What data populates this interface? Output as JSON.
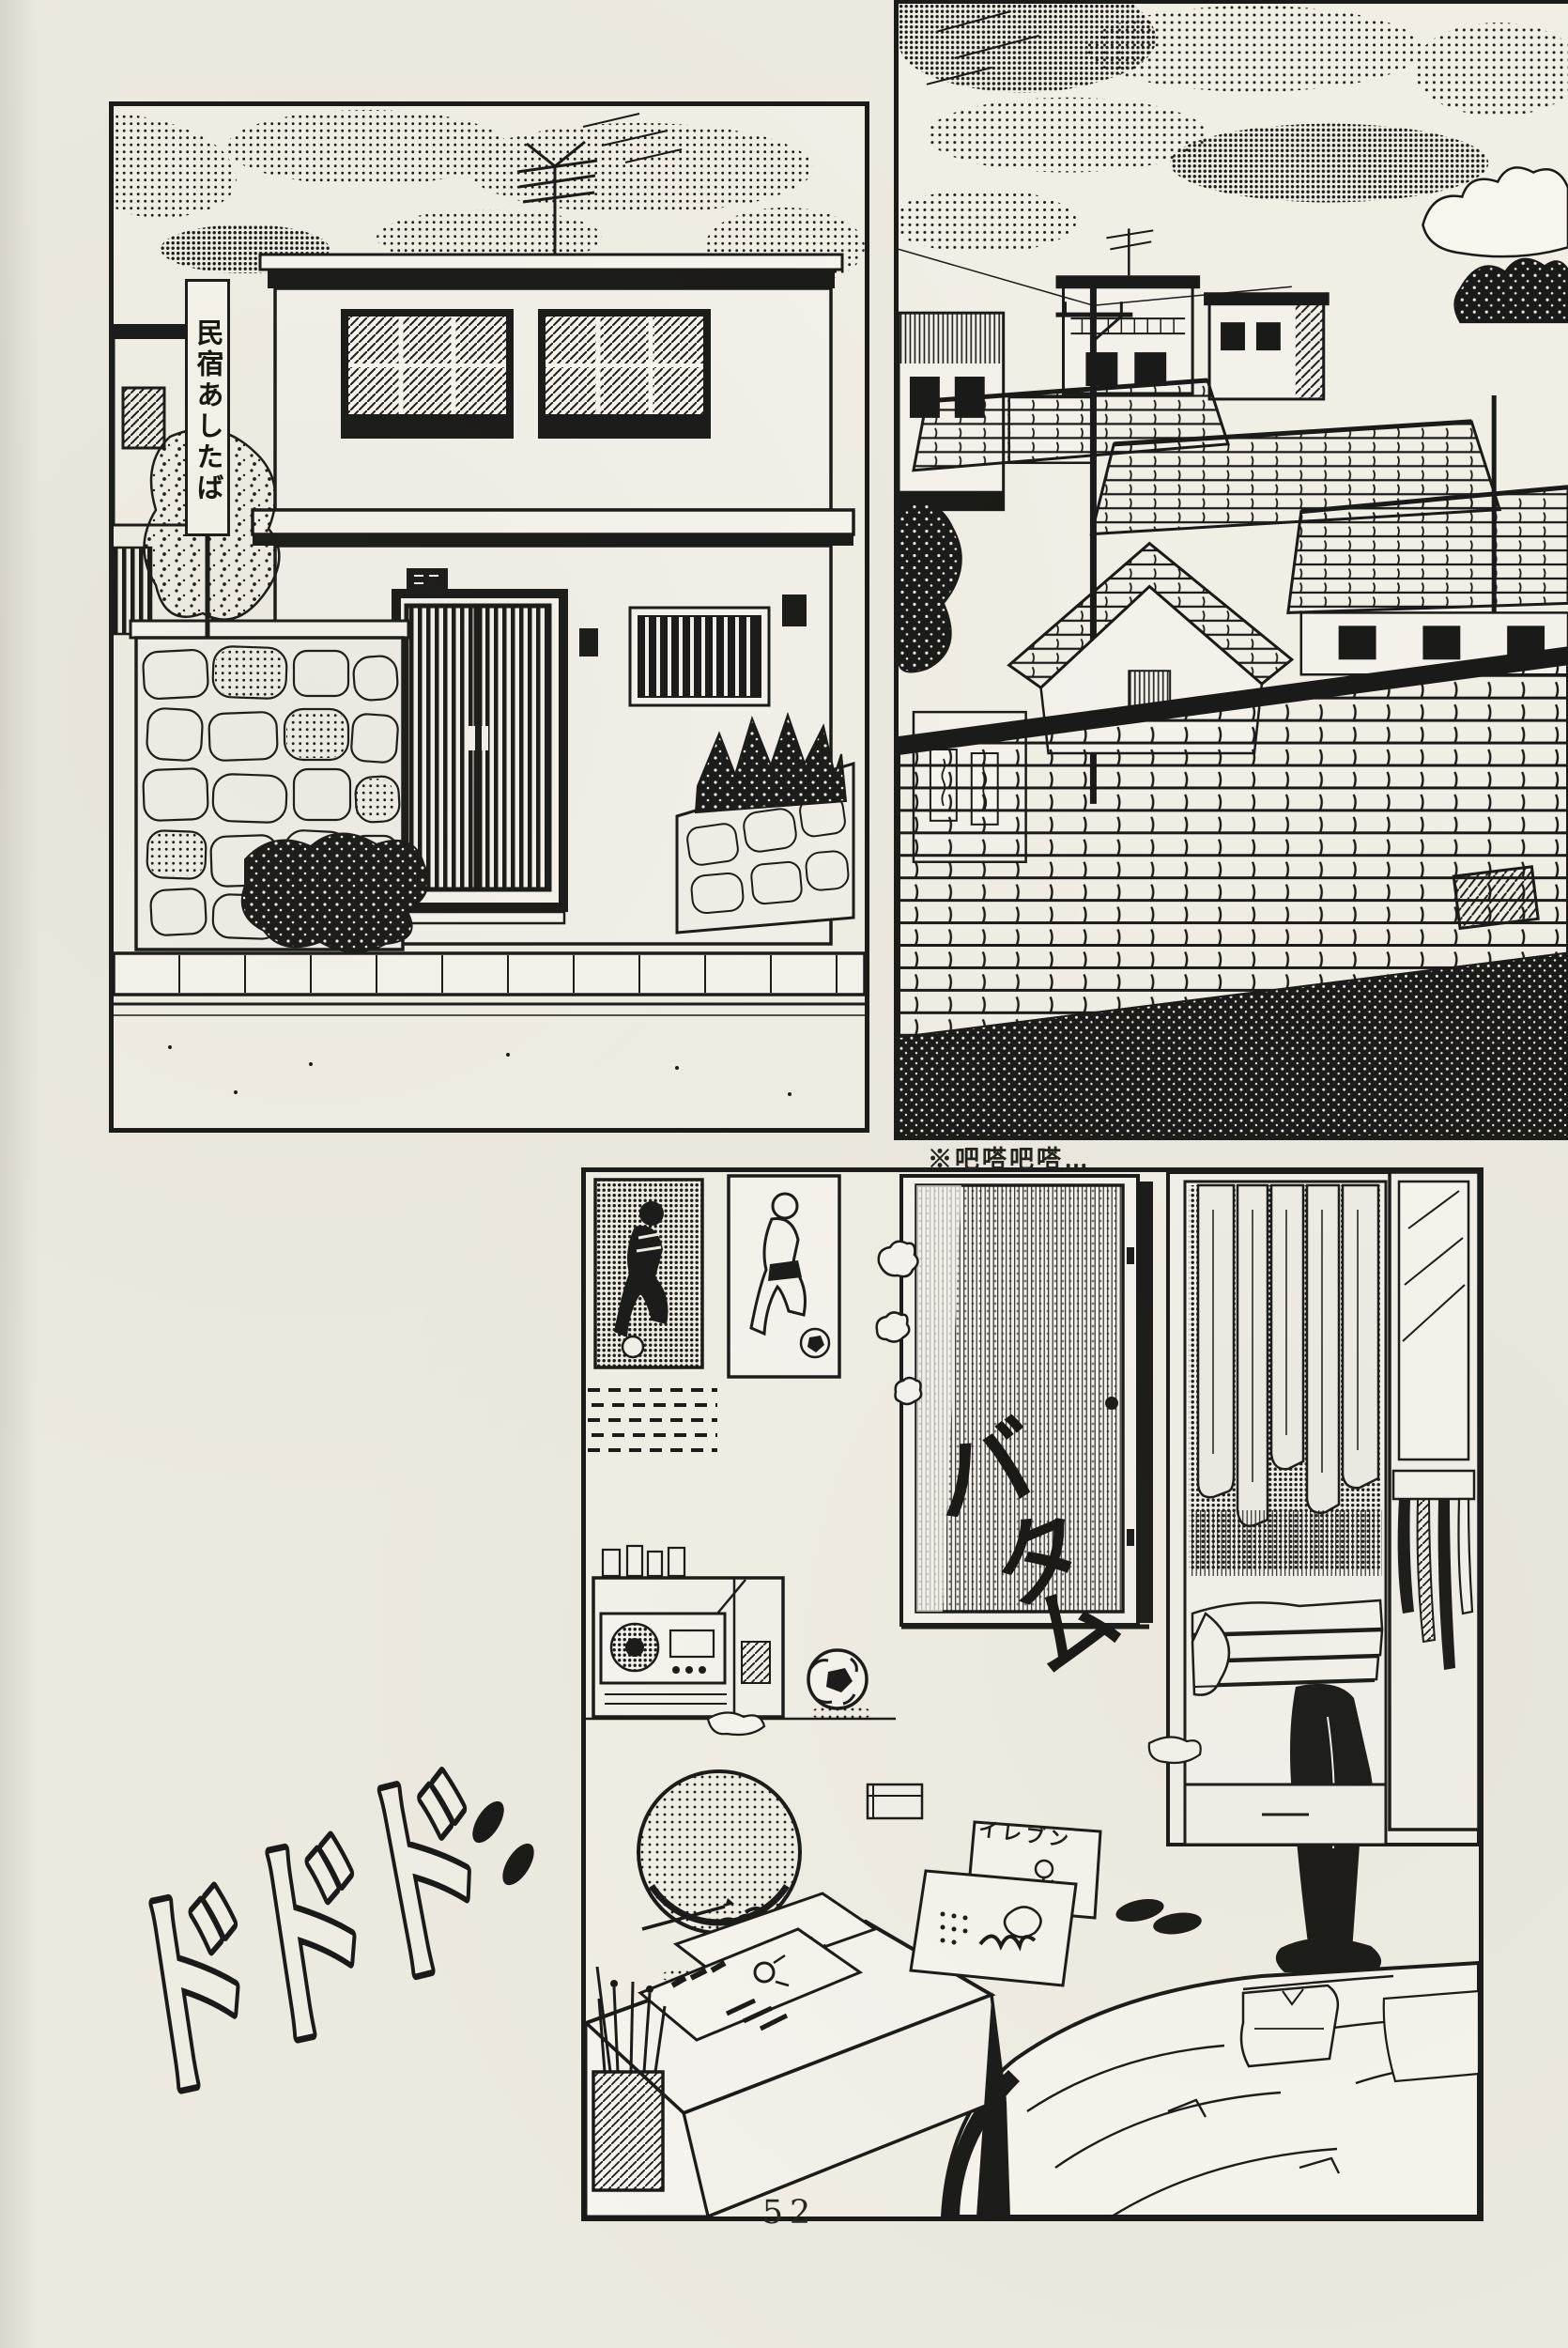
{
  "page": {
    "paper_color": "#ece9e1",
    "ink_color": "#1a1a18",
    "number": "52"
  },
  "texts": {
    "inn_sign_vertical": "民宿あしたば",
    "translator_note": "※吧嗒吧嗒…",
    "sfx_door_slam_chars": [
      "バ",
      "タ",
      "ム"
    ],
    "sfx_rumble_chars": [
      "ド",
      "ド",
      "ド"
    ],
    "floor_magazine_title": "イレブン"
  },
  "panels": [
    {
      "id": "inn-exterior",
      "alt": "Two-storey minshuku inn with antenna, barred windows, dark sliding entrance door, stone wall and vertical signboard"
    },
    {
      "id": "town-rooftops",
      "alt": "Tiled rooftops and utility pole of the town under a streaked halftone evening sky"
    },
    {
      "id": "bedroom",
      "alt": "Boy's room: soccer posters, slammed door with dust puffs, wardrobe with hanging clothes and ties, round chair, soccer ball, desk with magazines, unmade bed"
    }
  ]
}
